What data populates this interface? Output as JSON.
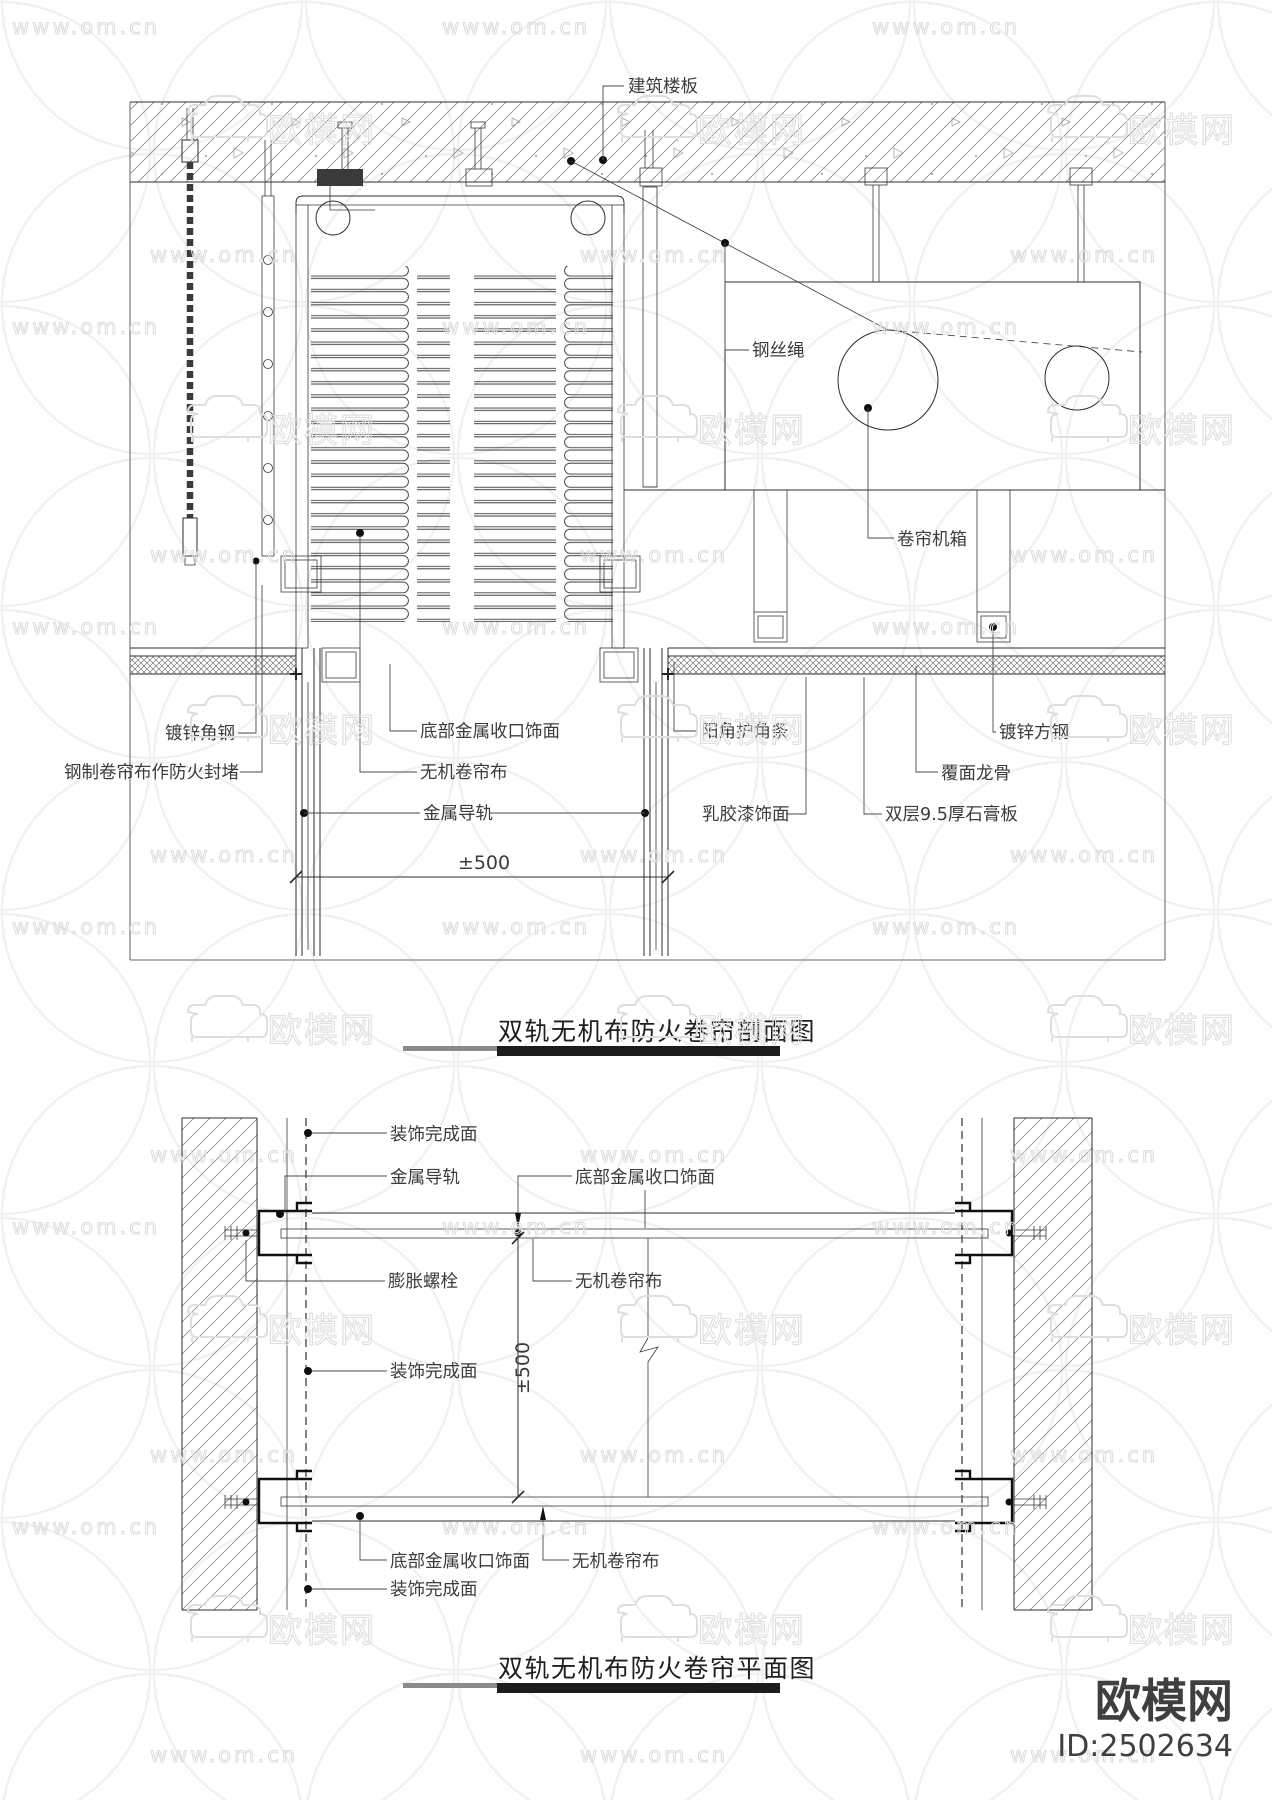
{
  "watermark": {
    "url_text": "www.om.cn",
    "brand": "欧模网",
    "brand_id": "ID:2502634"
  },
  "section_view": {
    "title": "双轨无机布防火卷帘剖面图",
    "labels": {
      "slab": "建筑楼板",
      "wire_rope": "钢丝绳",
      "machine_box": "卷帘机箱",
      "galvanized_angle": "镀锌角钢",
      "steel_curtain_seal": "钢制卷帘布作防火封堵",
      "bottom_metal_trim": "底部金属收口饰面",
      "inorganic_curtain": "无机卷帘布",
      "metal_track": "金属导轨",
      "corner_guard": "阳角护角条",
      "latex_paint": "乳胶漆饰面",
      "galvanized_square_steel": "镀锌方钢",
      "furring_keel": "覆面龙骨",
      "gypsum_board": "双层9.5厚石膏板",
      "dim_500": "±500"
    }
  },
  "plan_view": {
    "title": "双轨无机布防火卷帘平面图",
    "labels": {
      "finish_face_top": "装饰完成面",
      "metal_track": "金属导轨",
      "bottom_metal_trim_top": "底部金属收口饰面",
      "expansion_bolt": "膨胀螺栓",
      "inorganic_curtain_top": "无机卷帘布",
      "finish_face_mid": "装饰完成面",
      "dim_500": "±500",
      "bottom_metal_trim_bottom": "底部金属收口饰面",
      "inorganic_curtain_bottom": "无机卷帘布",
      "finish_face_bottom": "装饰完成面"
    }
  }
}
